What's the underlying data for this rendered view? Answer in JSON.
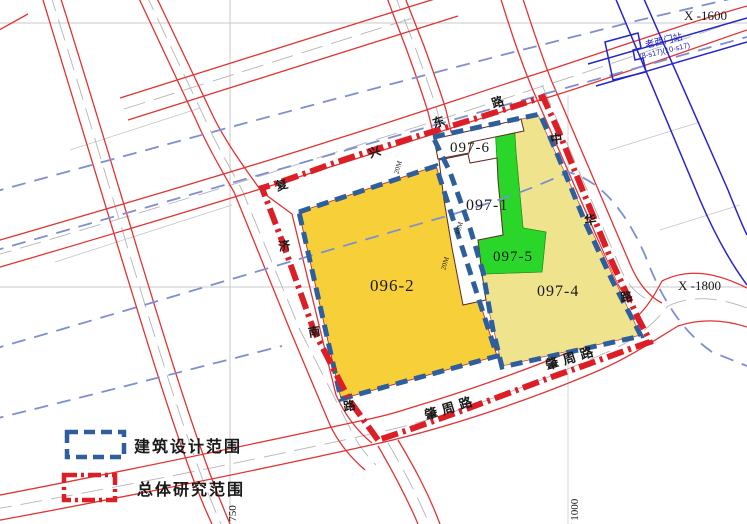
{
  "parcels": [
    {
      "id": "096-2",
      "color": "#F6CF39"
    },
    {
      "id": "097-1",
      "color": "#FFFFFF"
    },
    {
      "id": "097-4",
      "color": "#EFE48D"
    },
    {
      "id": "097-5",
      "color": "#2BD62B"
    },
    {
      "id": "097-6",
      "color": "#FFFFFF"
    }
  ],
  "roads": {
    "fuxing": [
      "复",
      "兴",
      "东",
      "路"
    ],
    "jinan": [
      "济",
      "南",
      "路"
    ],
    "zhonghua": [
      "中",
      "华",
      "路"
    ],
    "zhaozhou1": "肇周路",
    "zhaozhou2": "肇周路"
  },
  "station": {
    "name": "老西门站",
    "lines": "(8-s17)(10-s17)"
  },
  "grid": {
    "x1": "X  -1600",
    "x2": "X  -1800",
    "y1": "Y  750",
    "y2": "Y  1000"
  },
  "dims": {
    "d1": "20M",
    "d2": "40M",
    "d3": "20M"
  },
  "legend": {
    "design": "建筑设计范围",
    "research": "总体研究范围"
  },
  "colors": {
    "parcel_yellow": "#F6CF39",
    "parcel_pale_yellow": "#EFE48D",
    "parcel_green": "#2BD62B",
    "design_scope_blue": "#2E5F9C",
    "research_scope_red": "#DC1F26",
    "road_red": "#E23333",
    "metro_dash_blue": "#7E8FD0",
    "station_blue": "#2525CC"
  }
}
